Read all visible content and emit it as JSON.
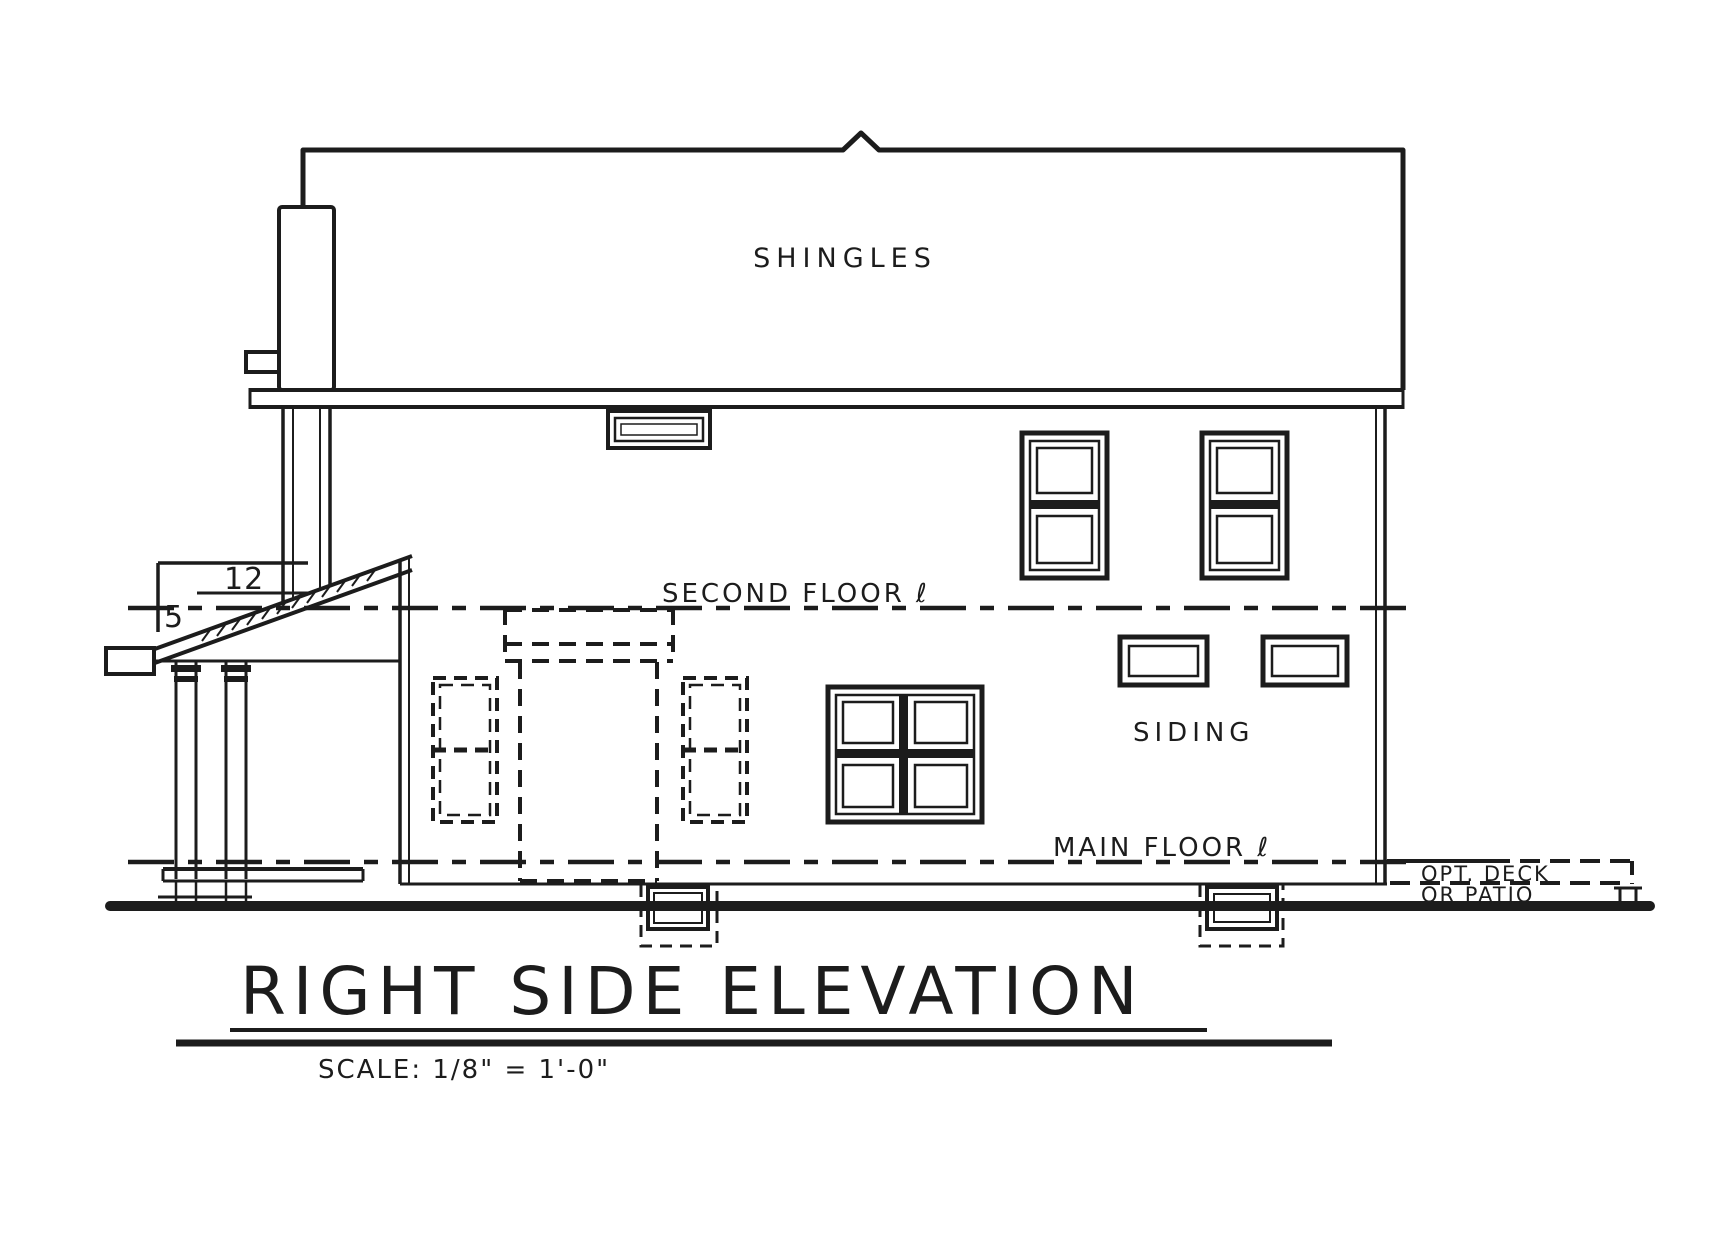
{
  "drawing": {
    "title": "RIGHT SIDE ELEVATION",
    "scale_note": "SCALE: 1/8\" = 1'-0\"",
    "labels": {
      "roof_material": "SHINGLES",
      "wall_material": "SIDING",
      "second_floor_line": "SECOND FLOOR ℓ",
      "main_floor_line": "MAIN FLOOR ℓ",
      "deck_option_line1": "OPT. DECK",
      "deck_option_line2": "OR PATIO",
      "roof_pitch_run": "12",
      "roof_pitch_rise": "5"
    },
    "colors": {
      "ink": "#1c1c1c",
      "paper": "#ffffff"
    }
  }
}
